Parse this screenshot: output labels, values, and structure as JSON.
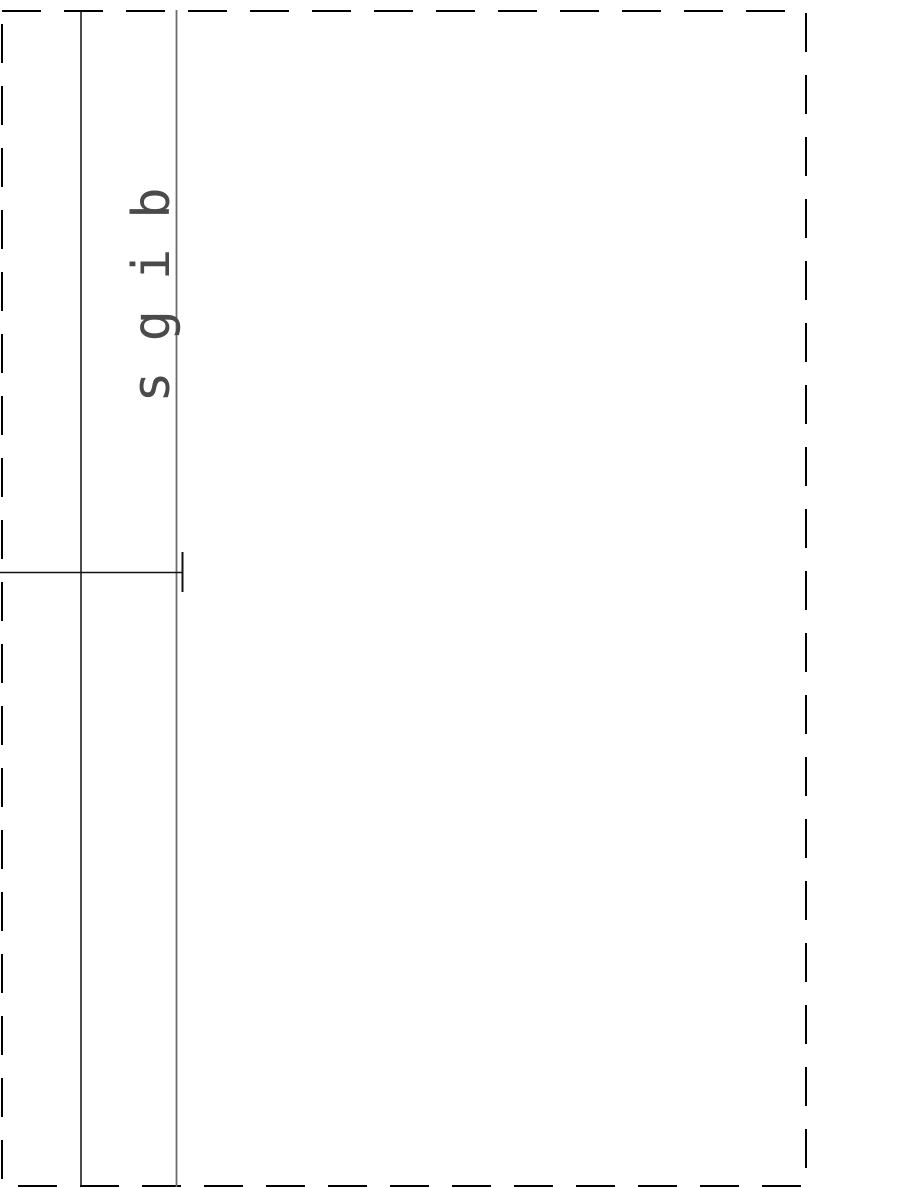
{
  "document": {
    "rotated_label": "sgib",
    "colors": {
      "background": "#ffffff",
      "border": "#000000",
      "rule_dark": "#111111",
      "rule_gray": "#6b6b6b",
      "label_text": "#4a4a4a"
    }
  }
}
